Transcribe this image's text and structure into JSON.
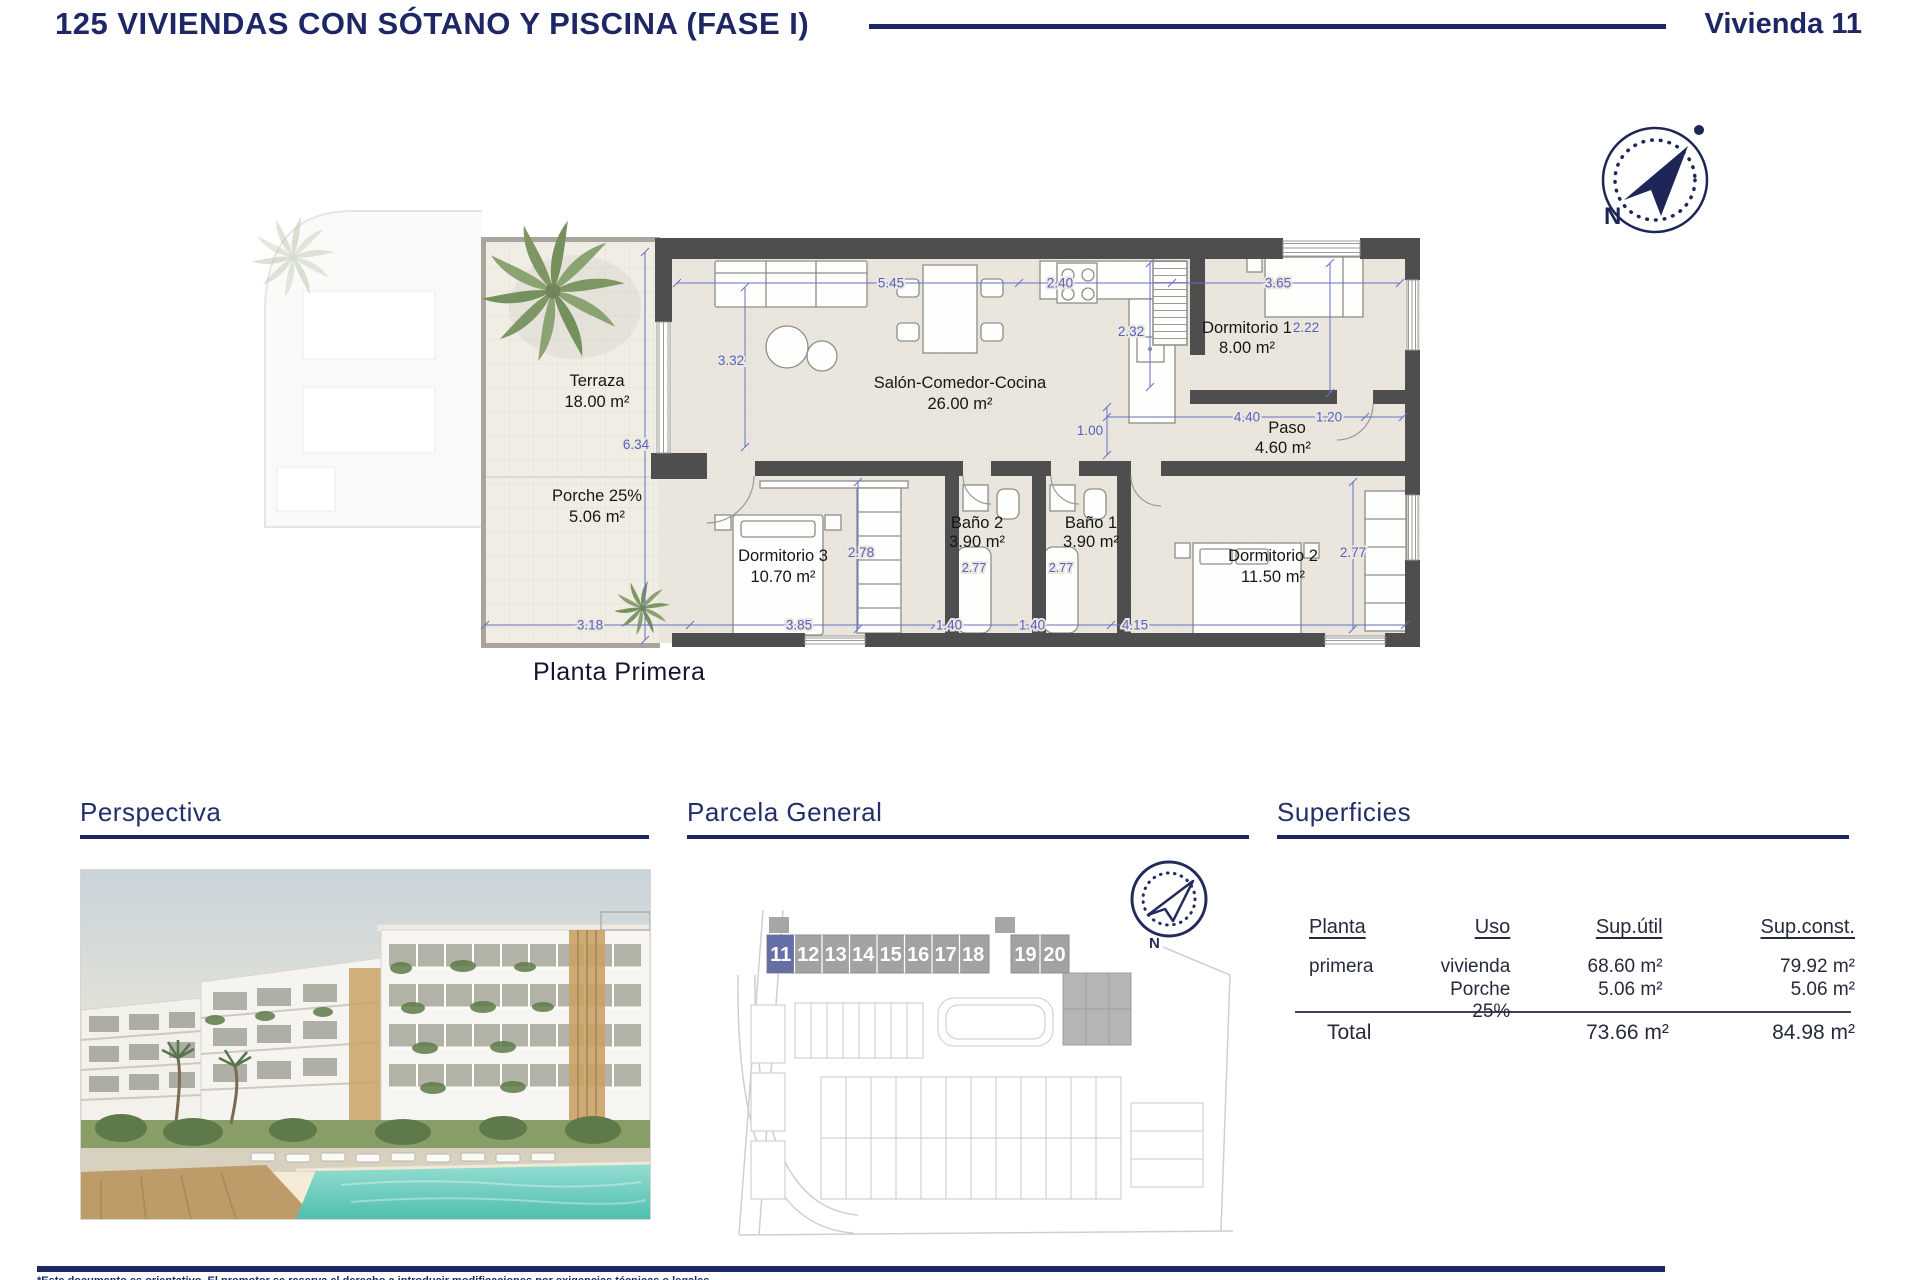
{
  "header": {
    "title": "125 VIVIENDAS CON SÓTANO Y PISCINA (FASE I)",
    "unit": "Vivienda 11"
  },
  "compass": {
    "n": "N"
  },
  "plan": {
    "caption": "Planta Primera",
    "rooms": [
      {
        "name": "Terraza",
        "area": "18.00 m²"
      },
      {
        "name": "Porche 25%",
        "area": "5.06 m²"
      },
      {
        "name": "Salón-Comedor-Cocina",
        "area": "26.00 m²"
      },
      {
        "name": "Dormitorio 1",
        "area": "8.00 m²"
      },
      {
        "name": "Paso",
        "area": "4.60 m²"
      },
      {
        "name": "Baño 2",
        "area": "3.90 m²"
      },
      {
        "name": "Baño 1",
        "area": "3.90 m²"
      },
      {
        "name": "Dormitorio 3",
        "area": "10.70 m²"
      },
      {
        "name": "Dormitorio 2",
        "area": "11.50 m²"
      }
    ],
    "dims": {
      "w_salon": "5.45",
      "w_cocina": "2.40",
      "w_dorm1": "3.65",
      "h_salon": "3.32",
      "h_terraza": "6.34",
      "h_cocina": "2.32",
      "h_dorm1": "2.22",
      "w_paso": "4.40",
      "w_paso2": "1.20",
      "h_paso": "1.00",
      "h_dorm3": "2.78",
      "ducha2": "2.77",
      "ducha1": "2.77",
      "h_dorm2": "2.77",
      "w_terraza": "3.18",
      "w_dorm3": "3.85",
      "w_bano2": "1.40",
      "w_bano1": "1.40",
      "w_dorm2": "4.15"
    }
  },
  "sections": {
    "perspectiva": "Perspectiva",
    "parcela": "Parcela General",
    "superficies": "Superficies"
  },
  "parcela": {
    "units": [
      "11",
      "12",
      "13",
      "14",
      "15",
      "16",
      "17",
      "18",
      "19",
      "20"
    ],
    "highlighted_unit": "11"
  },
  "table": {
    "col_planta": "Planta",
    "col_uso": "Uso",
    "col_util": "Sup.útil",
    "col_const": "Sup.const.",
    "rows": [
      {
        "planta": "primera",
        "uso": "vivienda",
        "util": "68.60 m²",
        "const": "79.92 m²"
      },
      {
        "planta": "",
        "uso": "Porche 25%",
        "util": "5.06 m²",
        "const": "5.06 m²"
      }
    ],
    "total_label": "Total",
    "total_util": "73.66 m²",
    "total_const": "84.98 m²"
  },
  "footer": {
    "disclaimer": "*Este documento es orientativo. El promotor se reserva el derecho a introducir modificaciones por exigencias técnicas o legales"
  },
  "colors": {
    "navy": "#1e2766",
    "dim_blue": "#5a65c2",
    "wall": "#4e4e4e",
    "floor": "#eae6dd",
    "highlight": "#656fa5",
    "pool": "#5fc8b6"
  }
}
